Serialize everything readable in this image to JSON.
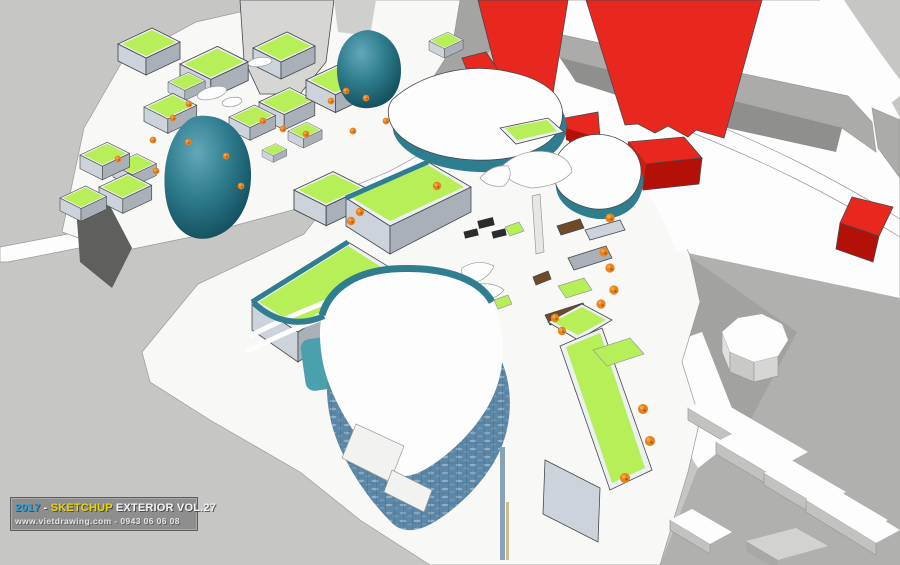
{
  "meta": {
    "title": "SketchUp aerial 3D architectural massing render",
    "description": "Bird's-eye view of a mixed-use complex: lime green roofs, teal glass pod buildings, blue glass rounded-triangle mall, red high-rise towers, white massing blocks and gray roads"
  },
  "watermark": {
    "year": "2017",
    "separator": " - ",
    "brand": "SKETCHUP",
    "series": " EXTERIOR VOL.27",
    "website": "www.vietdrawing.com",
    "line2_separator": " - ",
    "phone": "0943 06 06 08"
  },
  "palette": {
    "ground": "#c6c6c4",
    "groundLight": "#cfcfcd",
    "groundMed": "#ababa9",
    "groundDark": "#8f8f8d",
    "roadWhite": "#fdfdfd",
    "plazaWhite": "#f8f8f6",
    "outline": "#45484c",
    "lime": "#b7ef58",
    "teal": "#2f7e90",
    "tealDark": "#10505e",
    "glassBlue": "#5d87a7",
    "glassLight": "#a9c6d8",
    "glassDark": "#2f5a78",
    "red": "#e8271e",
    "redDark": "#b31108",
    "orange": "#e8821f",
    "orangeLight": "#f3a74e",
    "brown": "#6f4a26",
    "pool": "#4aa0ad",
    "faceLight": "#cdd3da",
    "faceMed": "#a9b0b8",
    "parapet": "#edf0f3",
    "towerGray": "#d6d6d4",
    "darkStrip": "#2c2c2a",
    "wmBg": "#8e8e8e",
    "wmBorder": "#5c5c5c",
    "wmBlue": "#2f9fd6",
    "wmYellow": "#edd500",
    "wmWhite": "#f4f4f4"
  }
}
